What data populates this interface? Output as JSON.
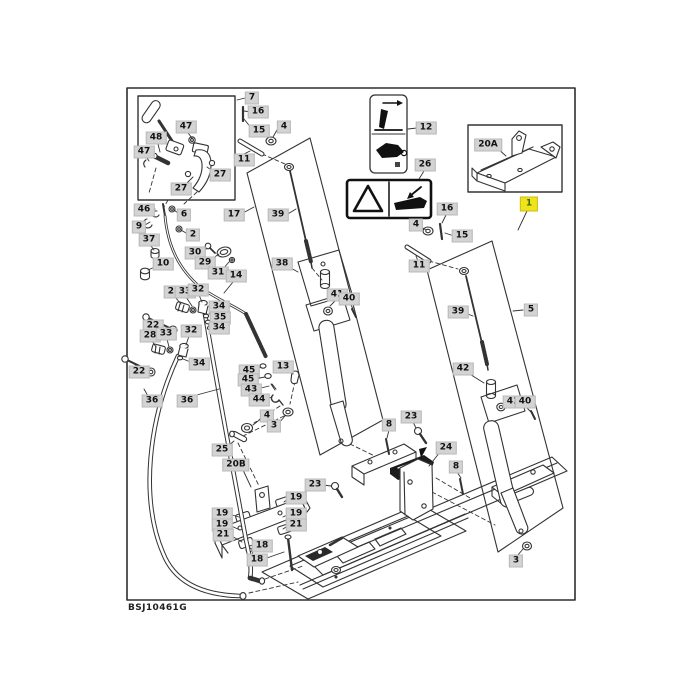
{
  "figure": {
    "code": "BSJ10461G",
    "kind": "exploded-parts-diagram"
  },
  "colors": {
    "background": "#ffffff",
    "frame": "#2e2e2e",
    "line": "#333333",
    "label_bg": "#d3d3d3",
    "label_text": "#111111",
    "highlight_bg": "#efe41c",
    "highlight_text": "#3a6d00",
    "decal_ink": "#111111"
  },
  "decals": {
    "decal_12_icon": "lever-direction-pictogram",
    "decal_26_icon": "warning-triangle-pinch-point-pictogram"
  },
  "callouts": [
    {
      "n": "7",
      "x": 252,
      "y": 98
    },
    {
      "n": "16",
      "x": 258,
      "y": 112
    },
    {
      "n": "15",
      "x": 259,
      "y": 131
    },
    {
      "n": "4",
      "x": 284,
      "y": 127
    },
    {
      "n": "11",
      "x": 244,
      "y": 160
    },
    {
      "n": "47",
      "x": 186,
      "y": 127
    },
    {
      "n": "48",
      "x": 156,
      "y": 138
    },
    {
      "n": "47",
      "x": 144,
      "y": 152
    },
    {
      "n": "27",
      "x": 220,
      "y": 175
    },
    {
      "n": "27",
      "x": 181,
      "y": 189
    },
    {
      "n": "17",
      "x": 234,
      "y": 215
    },
    {
      "n": "46",
      "x": 144,
      "y": 210
    },
    {
      "n": "6",
      "x": 184,
      "y": 215
    },
    {
      "n": "9",
      "x": 139,
      "y": 227
    },
    {
      "n": "2",
      "x": 193,
      "y": 235
    },
    {
      "n": "37",
      "x": 149,
      "y": 240
    },
    {
      "n": "30",
      "x": 195,
      "y": 253
    },
    {
      "n": "10",
      "x": 163,
      "y": 264
    },
    {
      "n": "29",
      "x": 205,
      "y": 263
    },
    {
      "n": "31",
      "x": 218,
      "y": 273
    },
    {
      "n": "14",
      "x": 236,
      "y": 276
    },
    {
      "n": "28",
      "x": 174,
      "y": 292
    },
    {
      "n": "33",
      "x": 185,
      "y": 292
    },
    {
      "n": "32",
      "x": 198,
      "y": 290
    },
    {
      "n": "34",
      "x": 219,
      "y": 307
    },
    {
      "n": "35",
      "x": 220,
      "y": 318
    },
    {
      "n": "34",
      "x": 219,
      "y": 328
    },
    {
      "n": "22",
      "x": 153,
      "y": 326
    },
    {
      "n": "28",
      "x": 150,
      "y": 336
    },
    {
      "n": "33",
      "x": 166,
      "y": 334
    },
    {
      "n": "32",
      "x": 191,
      "y": 331
    },
    {
      "n": "34",
      "x": 199,
      "y": 364
    },
    {
      "n": "22",
      "x": 139,
      "y": 372
    },
    {
      "n": "36",
      "x": 152,
      "y": 401
    },
    {
      "n": "36",
      "x": 187,
      "y": 401
    },
    {
      "n": "45",
      "x": 249,
      "y": 371
    },
    {
      "n": "45",
      "x": 248,
      "y": 380
    },
    {
      "n": "43",
      "x": 251,
      "y": 390
    },
    {
      "n": "44",
      "x": 259,
      "y": 400
    },
    {
      "n": "13",
      "x": 283,
      "y": 367
    },
    {
      "n": "4",
      "x": 267,
      "y": 416
    },
    {
      "n": "3",
      "x": 274,
      "y": 426
    },
    {
      "n": "25",
      "x": 222,
      "y": 450
    },
    {
      "n": "20B",
      "x": 236,
      "y": 465
    },
    {
      "n": "23",
      "x": 315,
      "y": 485
    },
    {
      "n": "19",
      "x": 296,
      "y": 498
    },
    {
      "n": "19",
      "x": 222,
      "y": 514
    },
    {
      "n": "19",
      "x": 296,
      "y": 514
    },
    {
      "n": "19",
      "x": 222,
      "y": 525
    },
    {
      "n": "21",
      "x": 296,
      "y": 525
    },
    {
      "n": "21",
      "x": 223,
      "y": 535
    },
    {
      "n": "18",
      "x": 262,
      "y": 546
    },
    {
      "n": "18",
      "x": 257,
      "y": 560
    },
    {
      "n": "12",
      "x": 426,
      "y": 128
    },
    {
      "n": "26",
      "x": 425,
      "y": 165
    },
    {
      "n": "20A",
      "x": 488,
      "y": 145
    },
    {
      "n": "1",
      "x": 529,
      "y": 204,
      "hl": true
    },
    {
      "n": "16",
      "x": 447,
      "y": 209
    },
    {
      "n": "4",
      "x": 416,
      "y": 225
    },
    {
      "n": "15",
      "x": 462,
      "y": 236
    },
    {
      "n": "11",
      "x": 419,
      "y": 266
    },
    {
      "n": "5",
      "x": 531,
      "y": 310
    },
    {
      "n": "39",
      "x": 278,
      "y": 215
    },
    {
      "n": "38",
      "x": 282,
      "y": 264
    },
    {
      "n": "41",
      "x": 337,
      "y": 295
    },
    {
      "n": "40",
      "x": 349,
      "y": 299
    },
    {
      "n": "39",
      "x": 458,
      "y": 312
    },
    {
      "n": "42",
      "x": 463,
      "y": 369
    },
    {
      "n": "41",
      "x": 513,
      "y": 402
    },
    {
      "n": "40",
      "x": 525,
      "y": 402
    },
    {
      "n": "23",
      "x": 411,
      "y": 417
    },
    {
      "n": "8",
      "x": 389,
      "y": 425
    },
    {
      "n": "24",
      "x": 446,
      "y": 448
    },
    {
      "n": "8",
      "x": 456,
      "y": 467
    },
    {
      "n": "3",
      "x": 516,
      "y": 561
    }
  ]
}
